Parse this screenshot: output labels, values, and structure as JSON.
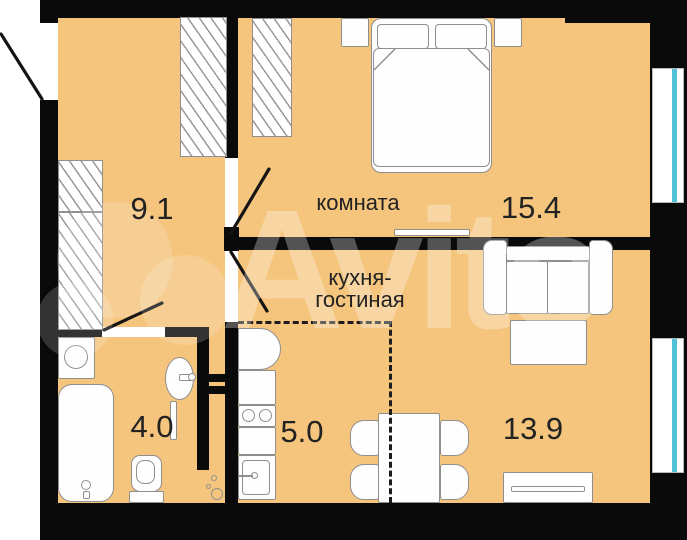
{
  "title": "apartment-floor-plan",
  "watermark": "Avito",
  "rooms": {
    "hallway": {
      "area": "9.1"
    },
    "bedroom": {
      "name": "комната",
      "area": "15.4"
    },
    "kitchen_living": {
      "name_line1": "кухня-",
      "name_line2": "гостиная",
      "kitchen_area": "5.0",
      "living_area": "13.9"
    },
    "bathroom": {
      "area": "4.0"
    }
  },
  "colors": {
    "floor": "#F5C57D",
    "wall": "#0A0A0A",
    "furniture_stroke": "#8F8F8F",
    "furniture_fill": "#FFFFFF",
    "window_glass": "#50C2D8",
    "label_text": "#222222",
    "watermark": "rgba(255,255,255,0.30)"
  }
}
